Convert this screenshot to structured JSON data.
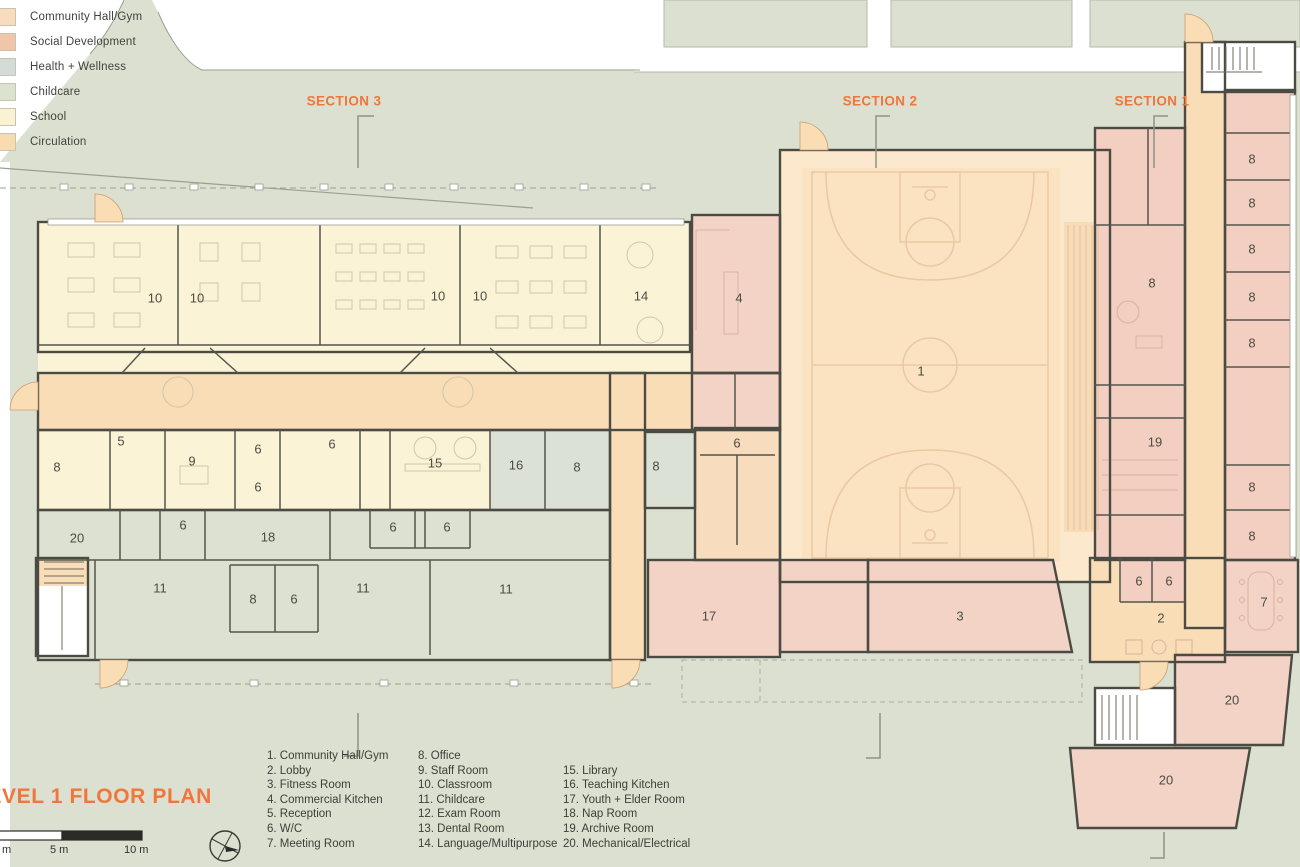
{
  "title": "LEVEL 1 FLOOR PLAN",
  "legend": {
    "items": [
      {
        "label": "Community Hall/Gym",
        "color": "#f8dcbb"
      },
      {
        "label": "Social Development",
        "color": "#f0c5a9"
      },
      {
        "label": "Health + Wellness",
        "color": "#d5dbd7"
      },
      {
        "label": "Childcare",
        "color": "#dbe2cf"
      },
      {
        "label": "School",
        "color": "#faf2d2"
      },
      {
        "label": "Circulation",
        "color": "#f8dcb0"
      }
    ]
  },
  "sections": [
    {
      "label": "SECTION 3",
      "x": 344,
      "y": 101
    },
    {
      "label": "SECTION 2",
      "x": 880,
      "y": 101
    },
    {
      "label": "SECTION 1",
      "x": 1152,
      "y": 101
    }
  ],
  "scale_bar": {
    "labels": [
      {
        "text": "m",
        "x": 2
      },
      {
        "text": "5 m",
        "x": 50
      },
      {
        "text": "10 m",
        "x": 124
      }
    ]
  },
  "room_legend": {
    "columns": [
      [
        "1. Community Hall/Gym",
        "2. Lobby",
        "3. Fitness Room",
        "4. Commercial Kitchen",
        "5. Reception",
        "6. W/C",
        "7. Meeting Room"
      ],
      [
        "8. Office",
        "9. Staff Room",
        "10. Classroom",
        "11. Childcare",
        "12. Exam Room",
        "13. Dental Room",
        "14. Language/Multipurpose"
      ],
      [
        "15. Library",
        "16. Teaching Kitchen",
        "17. Youth + Elder Room",
        "18. Nap Room",
        "19. Archive Room",
        "20. Mechanical/Electrical"
      ]
    ]
  },
  "room_labels": [
    {
      "t": "10",
      "x": 155,
      "y": 298
    },
    {
      "t": "10",
      "x": 197,
      "y": 298
    },
    {
      "t": "10",
      "x": 438,
      "y": 296
    },
    {
      "t": "10",
      "x": 480,
      "y": 296
    },
    {
      "t": "14",
      "x": 641,
      "y": 296
    },
    {
      "t": "4",
      "x": 739,
      "y": 298
    },
    {
      "t": "1",
      "x": 921,
      "y": 371
    },
    {
      "t": "8",
      "x": 57,
      "y": 467
    },
    {
      "t": "5",
      "x": 121,
      "y": 441
    },
    {
      "t": "9",
      "x": 192,
      "y": 461
    },
    {
      "t": "6",
      "x": 258,
      "y": 449
    },
    {
      "t": "6",
      "x": 258,
      "y": 487
    },
    {
      "t": "6",
      "x": 332,
      "y": 444
    },
    {
      "t": "15",
      "x": 435,
      "y": 463
    },
    {
      "t": "16",
      "x": 516,
      "y": 465
    },
    {
      "t": "8",
      "x": 577,
      "y": 467
    },
    {
      "t": "8",
      "x": 656,
      "y": 466
    },
    {
      "t": "6",
      "x": 737,
      "y": 443
    },
    {
      "t": "20",
      "x": 77,
      "y": 538
    },
    {
      "t": "6",
      "x": 183,
      "y": 525
    },
    {
      "t": "18",
      "x": 268,
      "y": 537
    },
    {
      "t": "6",
      "x": 393,
      "y": 527
    },
    {
      "t": "6",
      "x": 447,
      "y": 527
    },
    {
      "t": "11",
      "x": 160,
      "y": 588
    },
    {
      "t": "8",
      "x": 253,
      "y": 599
    },
    {
      "t": "6",
      "x": 294,
      "y": 599
    },
    {
      "t": "11",
      "x": 363,
      "y": 588
    },
    {
      "t": "11",
      "x": 506,
      "y": 589
    },
    {
      "t": "17",
      "x": 709,
      "y": 616
    },
    {
      "t": "3",
      "x": 960,
      "y": 616
    },
    {
      "t": "8",
      "x": 1152,
      "y": 283
    },
    {
      "t": "19",
      "x": 1155,
      "y": 442
    },
    {
      "t": "8",
      "x": 1252,
      "y": 159
    },
    {
      "t": "8",
      "x": 1252,
      "y": 203
    },
    {
      "t": "8",
      "x": 1252,
      "y": 249
    },
    {
      "t": "8",
      "x": 1252,
      "y": 297
    },
    {
      "t": "8",
      "x": 1252,
      "y": 343
    },
    {
      "t": "8",
      "x": 1252,
      "y": 487
    },
    {
      "t": "8",
      "x": 1252,
      "y": 536
    },
    {
      "t": "6",
      "x": 1139,
      "y": 581
    },
    {
      "t": "6",
      "x": 1169,
      "y": 581
    },
    {
      "t": "2",
      "x": 1161,
      "y": 618
    },
    {
      "t": "7",
      "x": 1264,
      "y": 602
    },
    {
      "t": "20",
      "x": 1232,
      "y": 700
    },
    {
      "t": "20",
      "x": 1166,
      "y": 780
    }
  ]
}
